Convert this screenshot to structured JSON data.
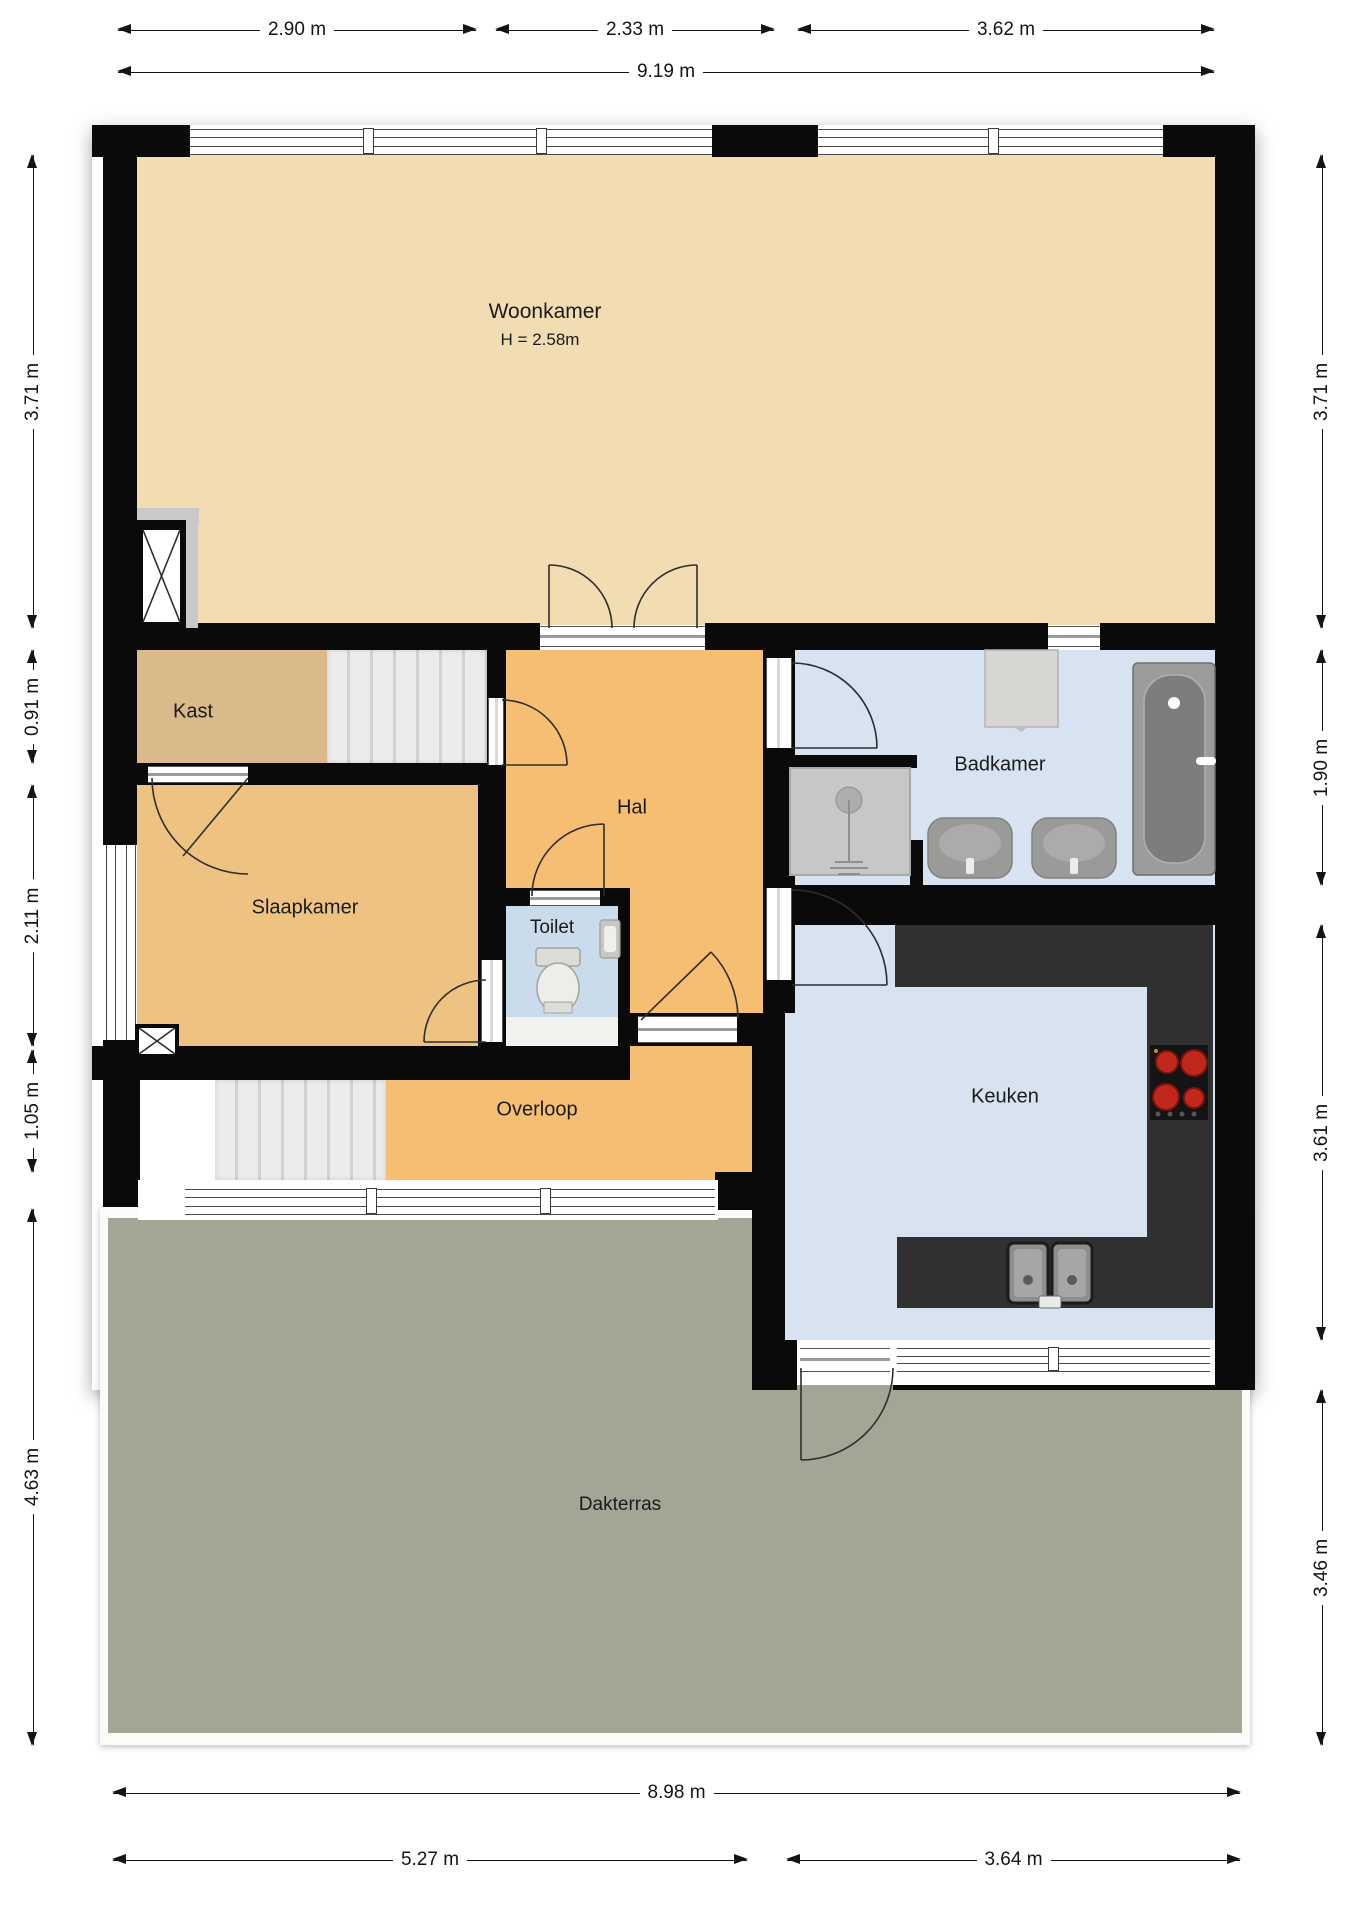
{
  "title": "Floor plan",
  "dimensions": {
    "top": [
      "2.90 m",
      "2.33 m",
      "3.62 m"
    ],
    "top_total": "9.19 m",
    "left": [
      "3.71 m",
      "0.91 m",
      "2.11 m",
      "1.05 m",
      "4.63 m"
    ],
    "right": [
      "3.71 m",
      "1.90 m",
      "3.61 m",
      "3.46 m"
    ],
    "bottom_total": "8.98 m",
    "bottom": [
      "5.27 m",
      "3.64 m"
    ]
  },
  "rooms": {
    "woonkamer": {
      "label": "Woonkamer",
      "height_note": "H = 2.58m"
    },
    "kast": {
      "label": "Kast"
    },
    "hal": {
      "label": "Hal"
    },
    "badkamer": {
      "label": "Badkamer"
    },
    "slaapkamer": {
      "label": "Slaapkamer"
    },
    "toilet": {
      "label": "Toilet"
    },
    "overloop": {
      "label": "Overloop"
    },
    "keuken": {
      "label": "Keuken"
    },
    "dakterras": {
      "label": "Dakterras"
    }
  },
  "fixtures": [
    "elevator-shaft",
    "stairs-upper",
    "stairs-lower",
    "double-door",
    "washer",
    "shower",
    "washbasin-left",
    "washbasin-right",
    "bathtub",
    "toilet-bowl",
    "hand-basin",
    "stove",
    "kitchen-sink",
    "terrace-railing"
  ],
  "colors": {
    "woonkamer": "#F2DCB2",
    "kast": "#DAB98B",
    "hal": "#F5BE72",
    "slaapkamer": "#EEC381",
    "overloop": "#F5BE72",
    "badkamer": "#D7E3F0",
    "toilet": "#CADCEC",
    "toilet_floor": "#F1F1EE",
    "keuken": "#D7E3F0",
    "dakterras": "#A3A694",
    "wall": "#0A0A0A",
    "counter": "#303030",
    "stove_burner": "#C0281E",
    "stair_landing": "#FFFFFF"
  }
}
